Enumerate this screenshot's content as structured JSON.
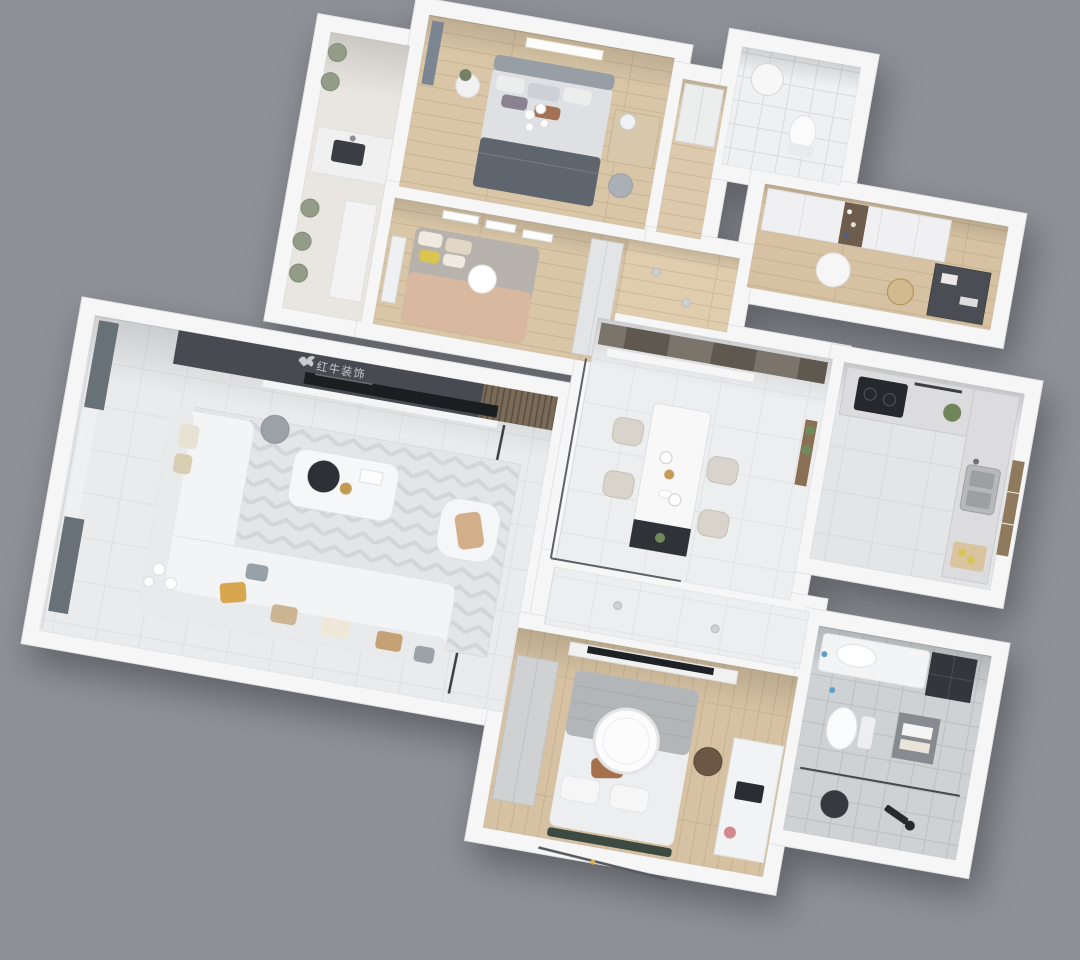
{
  "scene": {
    "type": "3D rendered apartment floor plan, top-down dollhouse view",
    "background_color": "#8e9196",
    "wall_color": "#f6f6f7",
    "brand": {
      "logo_text": "红牛装饰",
      "icon": "bull-logo-icon",
      "panel_color": "#474b51",
      "text_color": "#c9ccd0",
      "location": "living room media wall"
    },
    "rooms": [
      {
        "id": "living-room",
        "label": "Living Room",
        "floor": "light gray tile",
        "furniture": [
          "dark media wall with TV and wood-slat panel",
          "chevron area rug",
          "L-shaped white sectional sofa with yellow, beige and plaid pillows",
          "marble coffee table with dark round tray and gold flowers",
          "white armchair with tan cushion",
          "gray round pouf",
          "white sphere floor lamp",
          "dark gray curtains and sheer curtain on window wall",
          "dark floor inlay line"
        ]
      },
      {
        "id": "dining-room",
        "label": "Dining Room",
        "floor": "light gray tile",
        "furniture": [
          "dark panelled accent wall",
          "white console shelf",
          "white marble dining table with dark end cabinet and plant",
          "four beige dining chairs",
          "two white pendant lights",
          "glass partition with dark frame",
          "wall shelf with plants"
        ]
      },
      {
        "id": "kitchen",
        "label": "Kitchen",
        "floor": "gray tile",
        "furniture": [
          "L-shaped gray counter",
          "black cooktop with utensil rail",
          "double stainless sink",
          "potted plant",
          "wood cutting board with lemons",
          "wood-framed window"
        ]
      },
      {
        "id": "master-bedroom",
        "label": "Master Bedroom",
        "floor": "wood planks",
        "furniture": [
          "double bed with gray headboard, white/gray pillows, brown accent pillow and dark gray blanket",
          "wall art frame",
          "round nightstand with plant",
          "wood vanity desk with mirror",
          "gray stool",
          "blue-gray curtain",
          "white sphere ceiling lights"
        ]
      },
      {
        "id": "bedroom-2",
        "label": "Bedroom 2",
        "floor": "wood planks",
        "furniture": [
          "bed with gray and tan bedding and yellow pillow",
          "three wall art frames",
          "white wardrobe",
          "white sphere pendant lamp",
          "white rail headboard"
        ]
      },
      {
        "id": "bedroom-3",
        "label": "Bedroom 3",
        "floor": "wood planks",
        "furniture": [
          "bed with knitted gray throw, white duvet and brown pillow",
          "large round white ceiling lamp",
          "wall TV shelf",
          "gray wardrobe",
          "white desk with laptop and wood chair",
          "dark green foot bench",
          "clothes rack"
        ]
      },
      {
        "id": "bathroom",
        "label": "Bathroom",
        "floor": "gray tile grid",
        "furniture": [
          "white vanity with basin",
          "dark wall cabinet",
          "toilet",
          "towel shelf",
          "glass shower partition",
          "dark round shower stool",
          "black shower fixture"
        ]
      },
      {
        "id": "wc-top",
        "label": "Small WC / Heater Room",
        "floor": "white tile",
        "furniture": [
          "cylindrical water heater",
          "toilet"
        ]
      },
      {
        "id": "study-closet",
        "label": "Study / Walk-in Closet",
        "floor": "wood planks",
        "furniture": [
          "white wardrobe run with open display shelf",
          "round white table",
          "dark desk with papers",
          "beige chair with gold frame"
        ]
      },
      {
        "id": "entry-hall",
        "label": "Entry Hall",
        "floor": "wood planks",
        "furniture": [
          "recessed downlights"
        ]
      },
      {
        "id": "closet-hall",
        "label": "Closet Corridor",
        "floor": "wood planks",
        "furniture": [
          "white built-in closet"
        ]
      },
      {
        "id": "hallway",
        "label": "Hallway",
        "floor": "light gray tile",
        "furniture": [
          "recessed downlights"
        ]
      },
      {
        "id": "laundry-balcony",
        "label": "Laundry Balcony",
        "floor": "pale stone",
        "furniture": [
          "laundry counter with dark basin",
          "white planter bench",
          "row of plants"
        ]
      }
    ]
  },
  "palette": {
    "background": "#8e9196",
    "walls": "#f6f6f7",
    "wood_floor": "#d9c6a7",
    "wood_floor_dark": "#d3bd9a",
    "tile_floor": "#e9ebec",
    "bath_tile": "#ced2d5",
    "media_wall": "#474b51",
    "tv_black": "#1b1e21",
    "accent_yellow": "#d7a64e",
    "accent_brown": "#a4704e",
    "bench_green": "#3d4a41",
    "plant_green": "#6f8459",
    "glass_frame": "#45494d"
  }
}
